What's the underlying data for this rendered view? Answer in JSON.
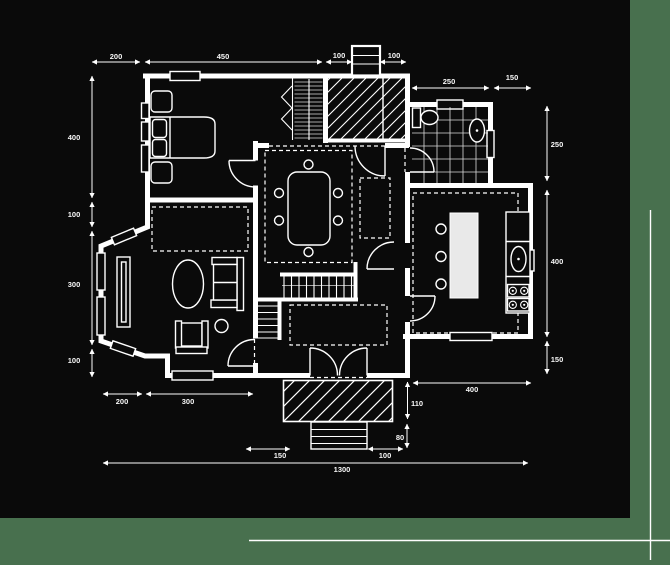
{
  "page": {
    "background_color": "#48704e",
    "canvas_color": "#0a0a0a",
    "line_color": "#ffffff"
  },
  "dims": {
    "top": [
      "200",
      "450",
      "100",
      "100"
    ],
    "top_right": [
      "250",
      "150"
    ],
    "left": [
      "400",
      "100",
      "300",
      "100"
    ],
    "right": [
      "250",
      "400",
      "150"
    ],
    "bottom_wall": [
      "200",
      "300"
    ],
    "entry": [
      "150",
      "100"
    ],
    "porch": [
      "110",
      "80"
    ],
    "bottom_right": [
      "400"
    ],
    "total": "1300"
  }
}
